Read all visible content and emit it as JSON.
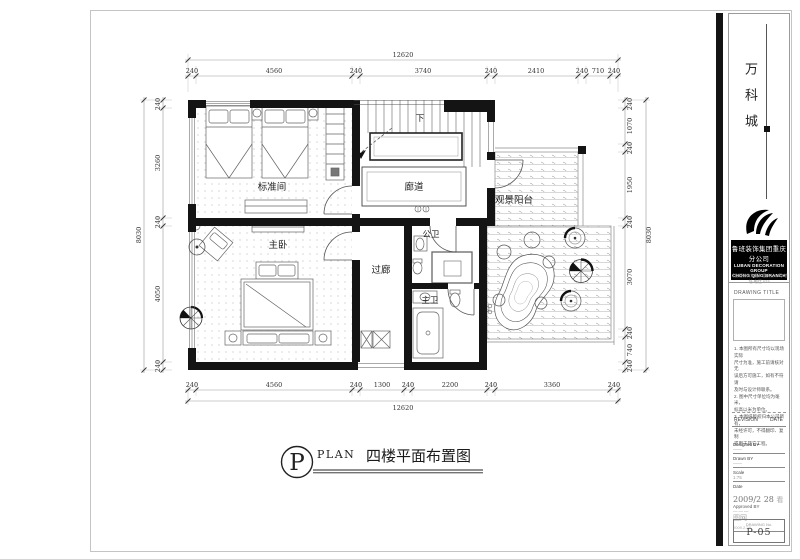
{
  "plan": {
    "rooms": {
      "standard_room": "标准间",
      "corridor": "廊道",
      "master_bedroom": "主卧",
      "passage": "过廊",
      "guest_bath": "公卫",
      "master_bath": "主卫",
      "balcony": "观景阳台",
      "stairs_down": "下"
    },
    "dims": {
      "top": {
        "total": "12620",
        "segments": [
          "240",
          "4560",
          "240",
          "3740",
          "240",
          "2410",
          "240",
          "710",
          "240"
        ]
      },
      "bottom": {
        "total": "12620",
        "segments": [
          "240",
          "4560",
          "240",
          "1300",
          "240",
          "2200",
          "240",
          "3360",
          "240"
        ]
      },
      "left": {
        "total": "8030",
        "segments": [
          "240",
          "3260",
          "240",
          "4050",
          "240"
        ]
      },
      "right": {
        "total": "8030",
        "segments": [
          "240",
          "1070",
          "240",
          "1950",
          "240",
          "3070",
          "240",
          "740",
          "240"
        ]
      }
    }
  },
  "caption": {
    "symbol": "P",
    "plan_word": "PLAN",
    "title": "四楼平面布置图"
  },
  "title_block": {
    "project_name": "万科城",
    "company_cn": "鲁班装饰集团重庆分公司",
    "company_en_1": "LUBAN DECORATION GROUP",
    "company_en_2": "CHONG QING BRANCH",
    "contact_line": "【鲁班装饰集团】重庆分公司 地址·电话 023",
    "drawing_title_label": "DRAWING TITLE",
    "notes": [
      "1. 本图所有尺寸均以现场实际",
      "尺寸为准，施工前请核对无",
      "误后方可施工，如有不符请",
      "及时与设计师联系。",
      "2. 图中尺寸单位均为毫米，",
      "标高以米为单位。",
      "3. 本图纸版权归本公司所有，",
      "未经许可，不得翻印、复制",
      "或用于其它工程。"
    ],
    "revision_label": "REVISION",
    "date_label": "DATE",
    "designed_by_label": "Designed BY",
    "designed_by_value": "——",
    "drawn_by_label": "Drawn BY",
    "drawn_by_value": "——",
    "scale_label": "Scale",
    "scale_value": "1:75",
    "date_field_label": "Date",
    "date_value": "2009/2 28",
    "watermark": "看图网",
    "date_small": "2009.2.28",
    "approved_label": "Approved BY",
    "approved_value": "———",
    "sheet_no_label": "DRAWING No.",
    "sheet_no": "P-05"
  }
}
